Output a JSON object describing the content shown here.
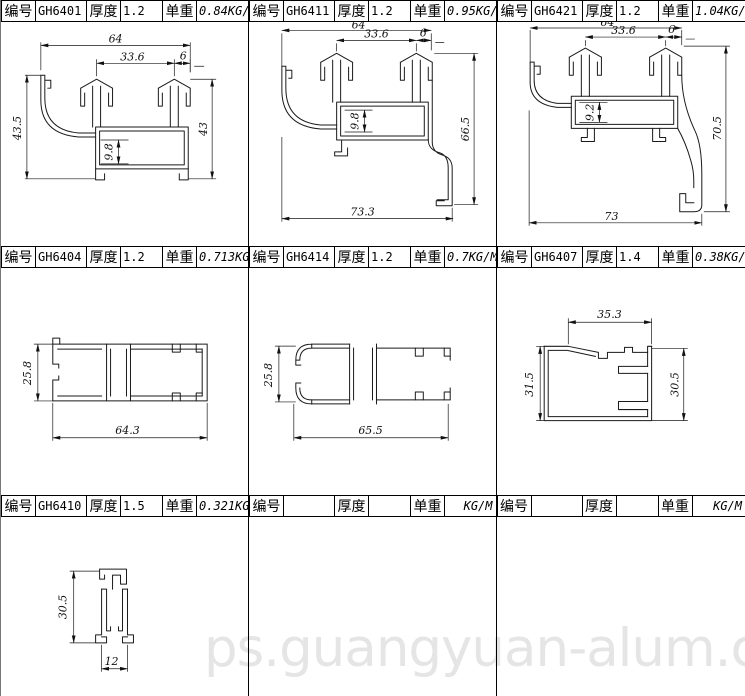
{
  "sheet": {
    "watermark": "ps.guangyuan-alum.com"
  },
  "labels": {
    "code": "编号",
    "thickness": "厚度",
    "weight": "单重"
  },
  "cells": [
    {
      "code": "GH6401",
      "thickness": "1.2",
      "weight": "0.84",
      "unit": "KG/M",
      "dims": {
        "width": "64",
        "inner_width": "33.6",
        "offset": "6",
        "height_left": "43.5",
        "height_right": "43",
        "channel": "9.8"
      }
    },
    {
      "code": "GH6411",
      "thickness": "1.2",
      "weight": "0.95",
      "unit": "KG/M",
      "dims": {
        "width": "64",
        "inner_width": "33.6",
        "offset": "6",
        "channel": "9.8",
        "height_right": "66.5",
        "width_bottom": "73.3"
      }
    },
    {
      "code": "GH6421",
      "thickness": "1.2",
      "weight": "1.04",
      "unit": "KG/M",
      "dims": {
        "width": "64",
        "inner_width": "33.6",
        "offset": "6",
        "channel": "9.2",
        "height_right": "70.5",
        "width_bottom": "73"
      }
    },
    {
      "code": "GH6404",
      "thickness": "1.2",
      "weight": "0.713",
      "unit": "KG/M",
      "dims": {
        "height_left": "25.8",
        "width_bottom": "64.3"
      }
    },
    {
      "code": "GH6414",
      "thickness": "1.2",
      "weight": "0.7",
      "unit": "KG/M",
      "dims": {
        "height_left": "25.8",
        "width_bottom": "65.5"
      }
    },
    {
      "code": "GH6407",
      "thickness": "1.4",
      "weight": "0.38",
      "unit": "KG/M",
      "dims": {
        "width_top": "35.3",
        "height_left": "31.5",
        "height_right": "30.5"
      }
    },
    {
      "code": "GH6410",
      "thickness": "1.5",
      "weight": "0.321",
      "unit": "KG/M",
      "dims": {
        "height_left": "30.5",
        "width_bottom": "12"
      }
    },
    {
      "code": "",
      "thickness": "",
      "weight": "",
      "unit": "KG/M",
      "dims": {}
    },
    {
      "code": "",
      "thickness": "",
      "weight": "",
      "unit": "KG/M",
      "dims": {}
    }
  ]
}
